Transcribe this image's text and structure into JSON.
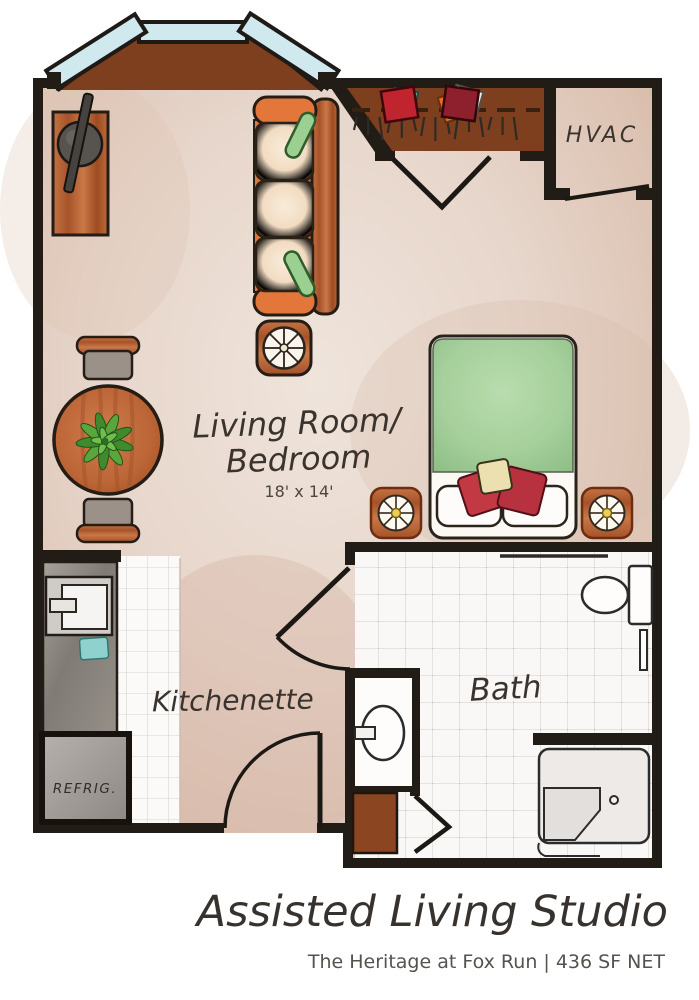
{
  "colors": {
    "wall": "#221c17",
    "floor_light": "#ece0d8",
    "floor_dark": "#cfab99",
    "bay_wood": "#7d3f1e",
    "closet_wood": "#7d3f1e",
    "window": "#cfe9ef",
    "sofa_orange": "#e2763b",
    "bed_green": "#a5cf9d",
    "pillow_red": "#c23843",
    "tile": "#f8f7f5",
    "counter_gray": "#8f8a84"
  },
  "rooms": {
    "living": {
      "line1": "Living Room/",
      "line2": "Bedroom",
      "dims": "18' x 14'"
    },
    "kitchenette": {
      "label": "Kitchenette"
    },
    "bath": {
      "label": "Bath"
    },
    "hvac": {
      "label": "HVAC"
    },
    "refrigerator": {
      "label": "REFRIG."
    }
  },
  "footer": {
    "title": "Assisted Living Studio",
    "subtitle": "The Heritage at Fox Run  |  436 SF NET"
  }
}
